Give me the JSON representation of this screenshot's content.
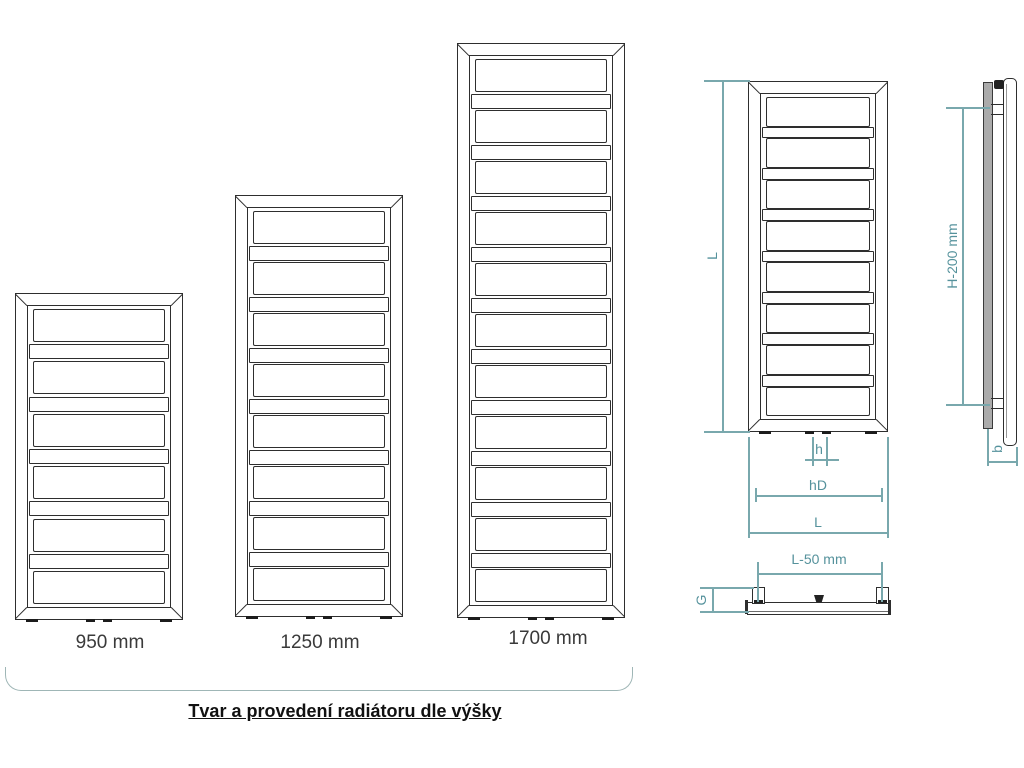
{
  "title": "Tvar a provedení radiátoru dle výšky",
  "diagram": {
    "radiators": [
      {
        "label": "950 mm",
        "panels": 6
      },
      {
        "label": "1250 mm",
        "panels": 8
      },
      {
        "label": "1700 mm",
        "panels": 11
      }
    ],
    "front_view": {
      "panels": 8,
      "height_label": "L",
      "pipe_pitch_label": "h",
      "connection_label": "hD",
      "width_label": "L"
    },
    "side_view": {
      "bracket_spacing_label": "H-200 mm",
      "depth_label": "b"
    },
    "top_view": {
      "bracket_width_label": "L-50 mm",
      "bracket_depth_label": "G"
    },
    "colors": {
      "drawing_line": "#2e2e2e",
      "dimension": "#5f9aa2",
      "group_bracket": "#9fb6b6"
    }
  }
}
